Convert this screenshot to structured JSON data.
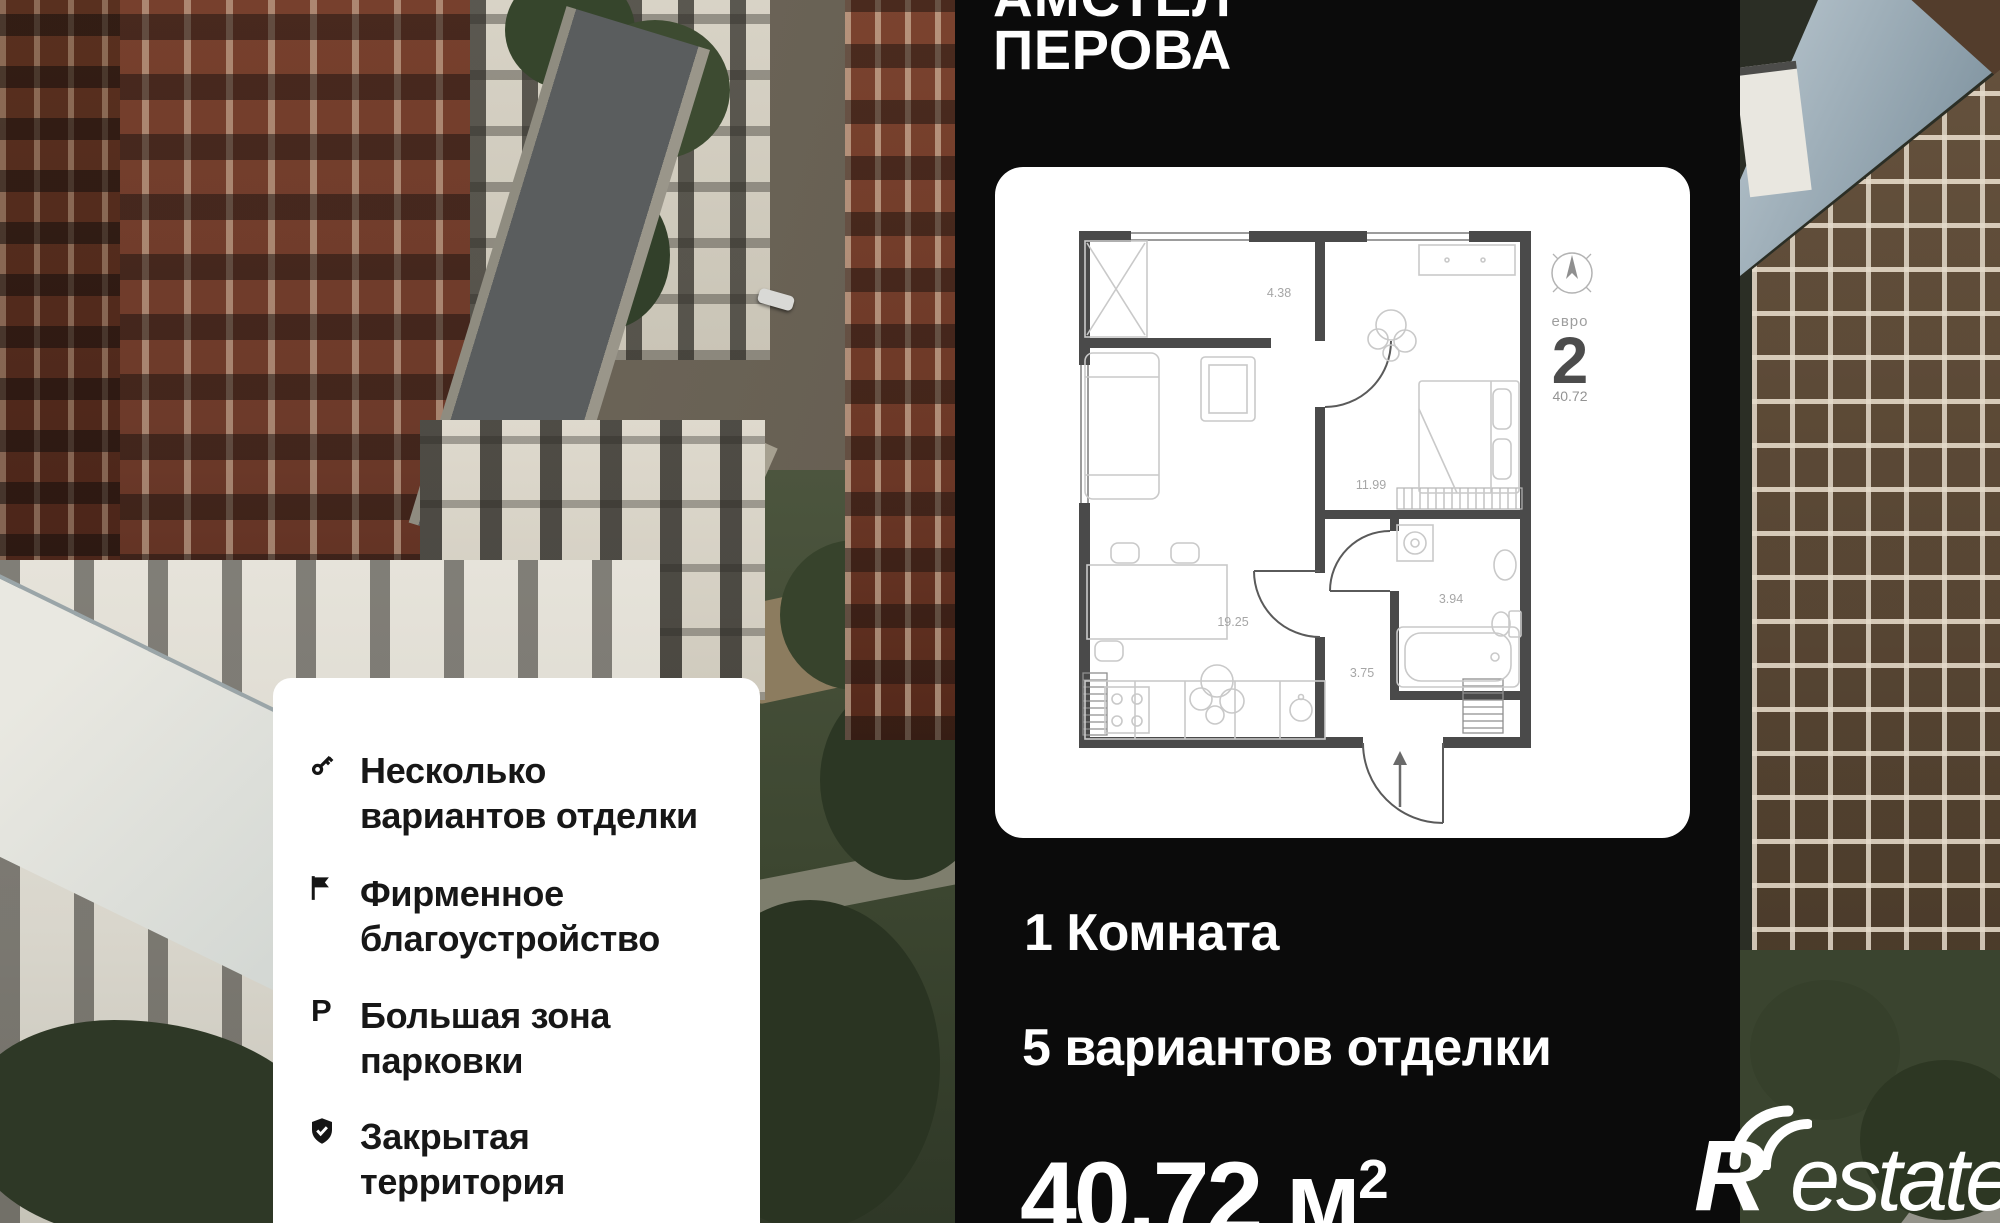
{
  "header": {
    "project_line1_cropped": "АМСТЕЛ",
    "project_line2": "ПЕРОВА"
  },
  "floorplan": {
    "badge": {
      "type_label": "евро",
      "type_number": "2",
      "area": "40.72"
    },
    "areas": {
      "balcony": "4.38",
      "bedroom": "11.99",
      "living": "19.25",
      "bathroom": "3.94",
      "hallway": "3.75"
    }
  },
  "details": {
    "rooms": "1 Комната",
    "finishes": "5 вариантов отделки",
    "area_value": "40.72",
    "area_unit": "м",
    "area_superscript": "2"
  },
  "features": {
    "items": [
      {
        "icon": "key-icon",
        "line1": "Несколько",
        "line2": "вариантов отделки"
      },
      {
        "icon": "flag-icon",
        "line1": "Фирменное",
        "line2": "благоустройство"
      },
      {
        "icon": "parking-icon",
        "icon_char": "P",
        "line1": "Большая зона",
        "line2": "парковки"
      },
      {
        "icon": "shield-check-icon",
        "line1": "Закрытая",
        "line2": "территория"
      }
    ]
  },
  "watermark": {
    "brand_initial": "R",
    "brand_rest": "estate"
  },
  "colors": {
    "panel_bg": "#0b0b0b",
    "card_bg": "#ffffff",
    "wall": "#4a4a4a",
    "furniture_line": "#c9c9c9",
    "area_label": "#a6a6a6",
    "text_light": "#ffffff",
    "text_dark": "#171717"
  }
}
